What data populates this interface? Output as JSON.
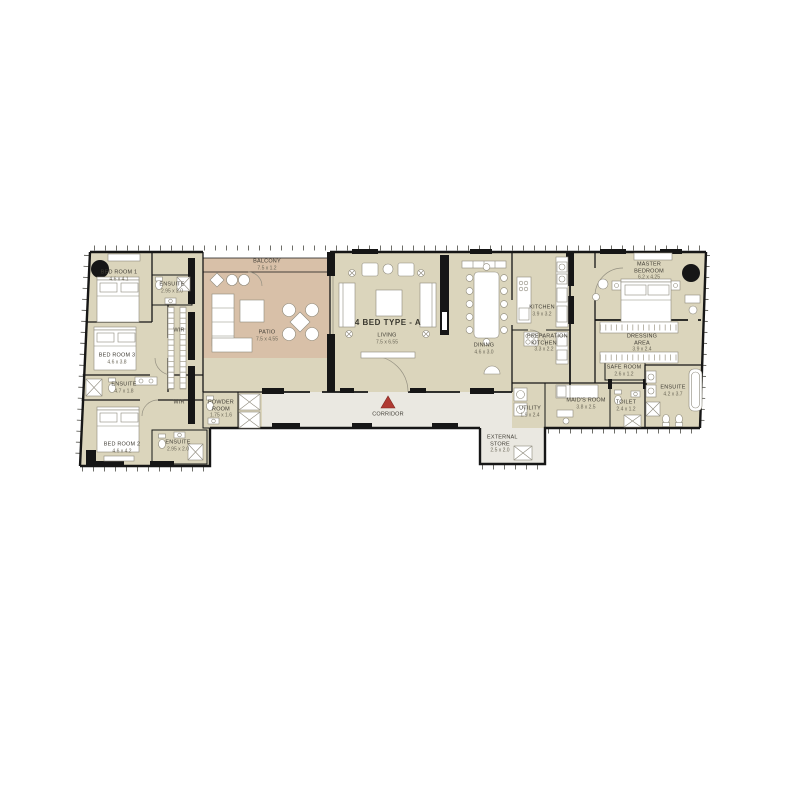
{
  "title": "4 BED TYPE - A",
  "rooms": {
    "bedroom1": {
      "label": "BED ROOM 1",
      "dim": "4.6 x 4.1"
    },
    "ensuite1": {
      "label": "ENSUITE",
      "dim": "2.95 x 2.0"
    },
    "wir": {
      "label": "WIR",
      "dim": ""
    },
    "bedroom3": {
      "label": "BED ROOM 3",
      "dim": "4.6 x 3.8"
    },
    "ensuite3": {
      "label": "ENSUITE",
      "dim": "4.7 x 1.8"
    },
    "wir2": {
      "label": "WIR",
      "dim": ""
    },
    "bedroom2": {
      "label": "BED ROOM 2",
      "dim": "4.6 x 4.2"
    },
    "ensuite2": {
      "label": "ENSUITE",
      "dim": "2.95 x 2.0"
    },
    "powder_room": {
      "label": "POWDER ROOM",
      "dim": "1.75 x 1.6"
    },
    "balcony": {
      "label": "BALCONY",
      "dim": "7.5 x 1.2"
    },
    "patio": {
      "label": "PATIO",
      "dim": "7.5 x 4.55"
    },
    "living": {
      "label": "LIVING",
      "dim": "7.5 x 6.55"
    },
    "dining": {
      "label": "DINING",
      "dim": "4.6 x 3.0"
    },
    "kitchen": {
      "label": "KITCHEN",
      "dim": "3.9 x 3.2"
    },
    "prep_kitchen": {
      "label": "PREPARATION KITCHEN",
      "dim": "3.3 x 2.2"
    },
    "master_bedroom": {
      "label": "MASTER BEDROOM",
      "dim": "6.2 x 4.25"
    },
    "dressing_area": {
      "label": "DRESSING AREA",
      "dim": "3.9 x 2.4"
    },
    "safe_room": {
      "label": "SAFE ROOM",
      "dim": "2.6 x 1.2"
    },
    "master_ensuite": {
      "label": "ENSUITE",
      "dim": "4.2 x 3.7"
    },
    "toilet": {
      "label": "TOILET",
      "dim": "2.4 x 1.2"
    },
    "maids_room": {
      "label": "MAID'S ROOM",
      "dim": "3.8 x 2.5"
    },
    "utility": {
      "label": "UTILITY",
      "dim": "1.9 x 2.4"
    },
    "external_store": {
      "label": "EXTERNAL STORE",
      "dim": "2.5 x 2.0"
    },
    "corridor": {
      "label": "CORRIDOR",
      "dim": ""
    }
  },
  "colors": {
    "interior": "#dbd5bc",
    "outdoor": "#d8c0a8",
    "corridor": "#eae8e1",
    "wall": "#161616",
    "entrance_marker": "#b03a32"
  }
}
